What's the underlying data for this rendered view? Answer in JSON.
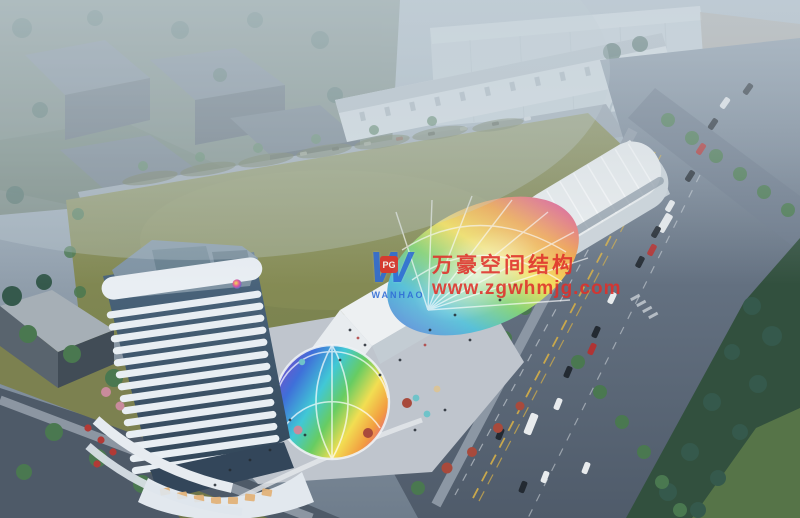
{
  "meta": {
    "type": "architectural-aerial-rendering",
    "description": "Aerial rendering of a mixed-use commercial plaza with tower, rainbow membrane canopies and boulevard, adjacent to Wanda Plaza"
  },
  "signs": {
    "wanda_plaza": "万达广场"
  },
  "watermark": {
    "logo_letter": "W",
    "logo_badge": "PG",
    "logo_name": "WANHAO",
    "company": "万豪空间结构",
    "website": "www.zgwhmjg.com"
  },
  "colors": {
    "haze": "#b7c4ce",
    "lawn": "#868c55",
    "lawn-shadow": "#5c6539",
    "road": "#5d6a7a",
    "road-dark": "#4b5765",
    "sidewalk": "#939ea9",
    "strip-white": "#edf0f2",
    "facade-shadow": "#c3ccd3",
    "tower-white": "#e8eef3",
    "tower-glass": "#46607a",
    "deck": "#7f93a3",
    "park-dark": "#32503e",
    "park-lawn": "#5a7849",
    "tree-green": "#4a7850",
    "tree-dark": "#35594c",
    "tree-red": "#a84a3c",
    "tree-pink": "#c98b9c",
    "car-white": "#e8ebed",
    "car-dark": "#232a32",
    "car-red": "#b03434",
    "lane-yellow": "#c9a84c",
    "dome-purple": "#7a4fc9",
    "dome-blue": "#3f6fd9",
    "dome-cyan": "#41c8d6",
    "dome-green": "#67cc62",
    "dome-yellow": "#f2de52",
    "dome-orange": "#f29c40",
    "dome-pink": "#e0559a",
    "mall-white": "#ccd6dc",
    "sign-white": "#eef3f5",
    "watermark-red": "#e0302a",
    "logo-blue": "#2e6bd6",
    "warm-light": "#e2b176"
  }
}
